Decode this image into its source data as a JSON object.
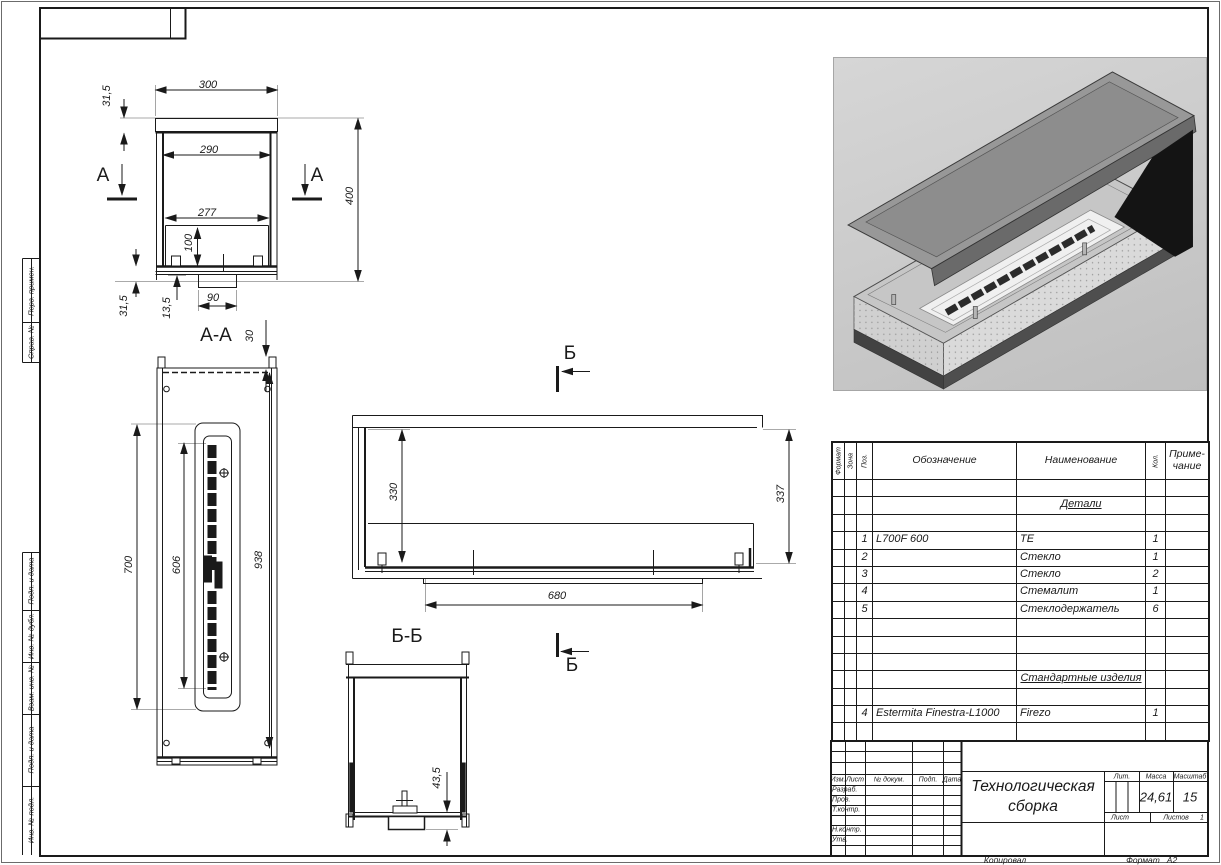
{
  "drawing": {
    "views": {
      "end_section": {
        "marker_a_left": "А",
        "marker_a_right": "А",
        "dim_300": "300",
        "dim_315_top": "31,5",
        "dim_290": "290",
        "dim_277": "277",
        "dim_100": "100",
        "dim_400": "400",
        "dim_90": "90",
        "dim_315_bottom": "31,5",
        "dim_135": "13,5"
      },
      "section_aa": {
        "title": "А-А",
        "dim_30": "30",
        "dim_700": "700",
        "dim_606": "606",
        "dim_938": "938"
      },
      "front": {
        "marker_b": "Б",
        "dim_330": "330",
        "dim_337": "337",
        "dim_680": "680"
      },
      "section_bb": {
        "title": "Б-Б",
        "marker_b": "Б",
        "dim_435": "43,5"
      }
    }
  },
  "margin": {
    "col1": "Перв. примен.",
    "col2": "Справ. №",
    "col3": "Подп. и дата",
    "col4": "Инв. № дубл.",
    "col5": "Взам. инв. №",
    "col6": "Подп. и дата",
    "col7": "Инв. № подл."
  },
  "spec": {
    "headers": {
      "format": "Формат",
      "zone": "Зона",
      "pos": "Поз.",
      "designation": "Обозначение",
      "name": "Наименование",
      "qty": "Кол.",
      "note": "Приме-\nчание"
    },
    "rows": [
      {},
      {
        "section": "Детали"
      },
      {},
      {
        "pos": "1",
        "designation": "L700F 600",
        "name": "ТЕ",
        "qty": "1"
      },
      {
        "pos": "2",
        "designation": "",
        "name": "Стекло",
        "qty": "1"
      },
      {
        "pos": "3",
        "designation": "",
        "name": "Стекло",
        "qty": "2"
      },
      {
        "pos": "4",
        "designation": "",
        "name": "Стемалит",
        "qty": "1"
      },
      {
        "pos": "5",
        "designation": "",
        "name": "Стеклодержатель",
        "qty": "6"
      },
      {},
      {},
      {},
      {
        "section": "Стандартные изделия"
      },
      {},
      {
        "pos": "4",
        "designation": "Estermita Finestra-L1000",
        "name": "Firezo",
        "qty": "1"
      },
      {}
    ]
  },
  "title_block": {
    "cols": {
      "izm": "Изм.",
      "list": "Лист",
      "doc": "№ докум.",
      "sign": "Подп.",
      "date": "Дата"
    },
    "roles": {
      "developed": "Разраб.",
      "checked": "Пров.",
      "tcontrol": "Т.контр.",
      "ncontrol": "Н.контр.",
      "approved": "Утв."
    },
    "title_line1": "Технологическая",
    "title_line2": "сборка",
    "lit": "Лит.",
    "mass_label": "Масса",
    "mass": "24,61",
    "scale_label": "Масштаб",
    "scale": "15",
    "sheet_label": "Лист",
    "sheets_label": "Листов",
    "sheets": "1"
  },
  "footer": {
    "copied": "Копировал",
    "format_label": "Формат",
    "format": "А2"
  }
}
